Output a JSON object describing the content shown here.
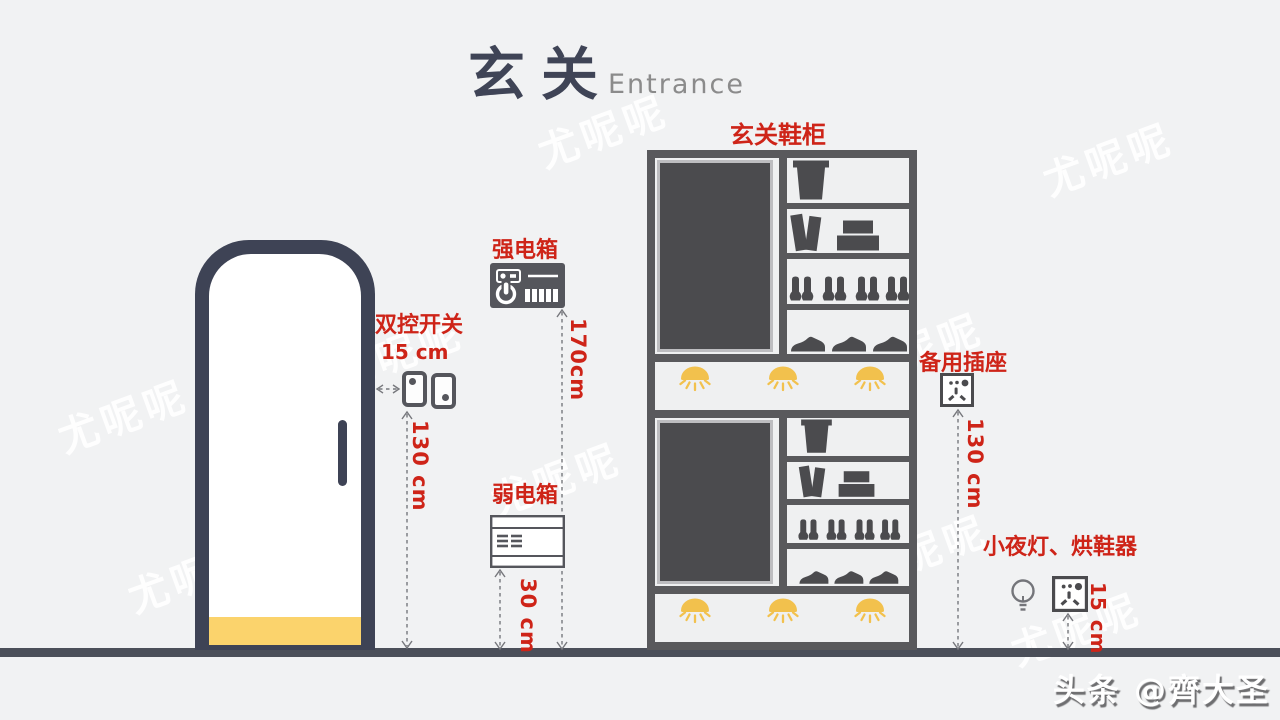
{
  "title": {
    "cn": "玄关",
    "en": "Entrance"
  },
  "cabinet_label": "玄关鞋柜",
  "watermark_text": "尤呢呢",
  "credit": "头条 @齊大圣",
  "annotations": {
    "switch": {
      "label": "双控开关",
      "distance": "15 cm",
      "height": "130 cm"
    },
    "strong_box": {
      "label": "强电箱",
      "height": "170cm"
    },
    "weak_box": {
      "label": "弱电箱",
      "height": "30 cm"
    },
    "spare_socket": {
      "label": "备用插座",
      "height": "130 cm"
    },
    "night_light": {
      "label": "小夜灯、烘鞋器",
      "height": "15 cm"
    }
  },
  "colors": {
    "background": "#f1f2f3",
    "floor": "#4b4f59",
    "door_frame": "#3e4355",
    "door_kick": "#fbd36c",
    "accent_red": "#ce2418",
    "cabinet_gray": "#59595c",
    "item_gray": "#4b4b4e",
    "light_yellow": "#f2c14d"
  }
}
